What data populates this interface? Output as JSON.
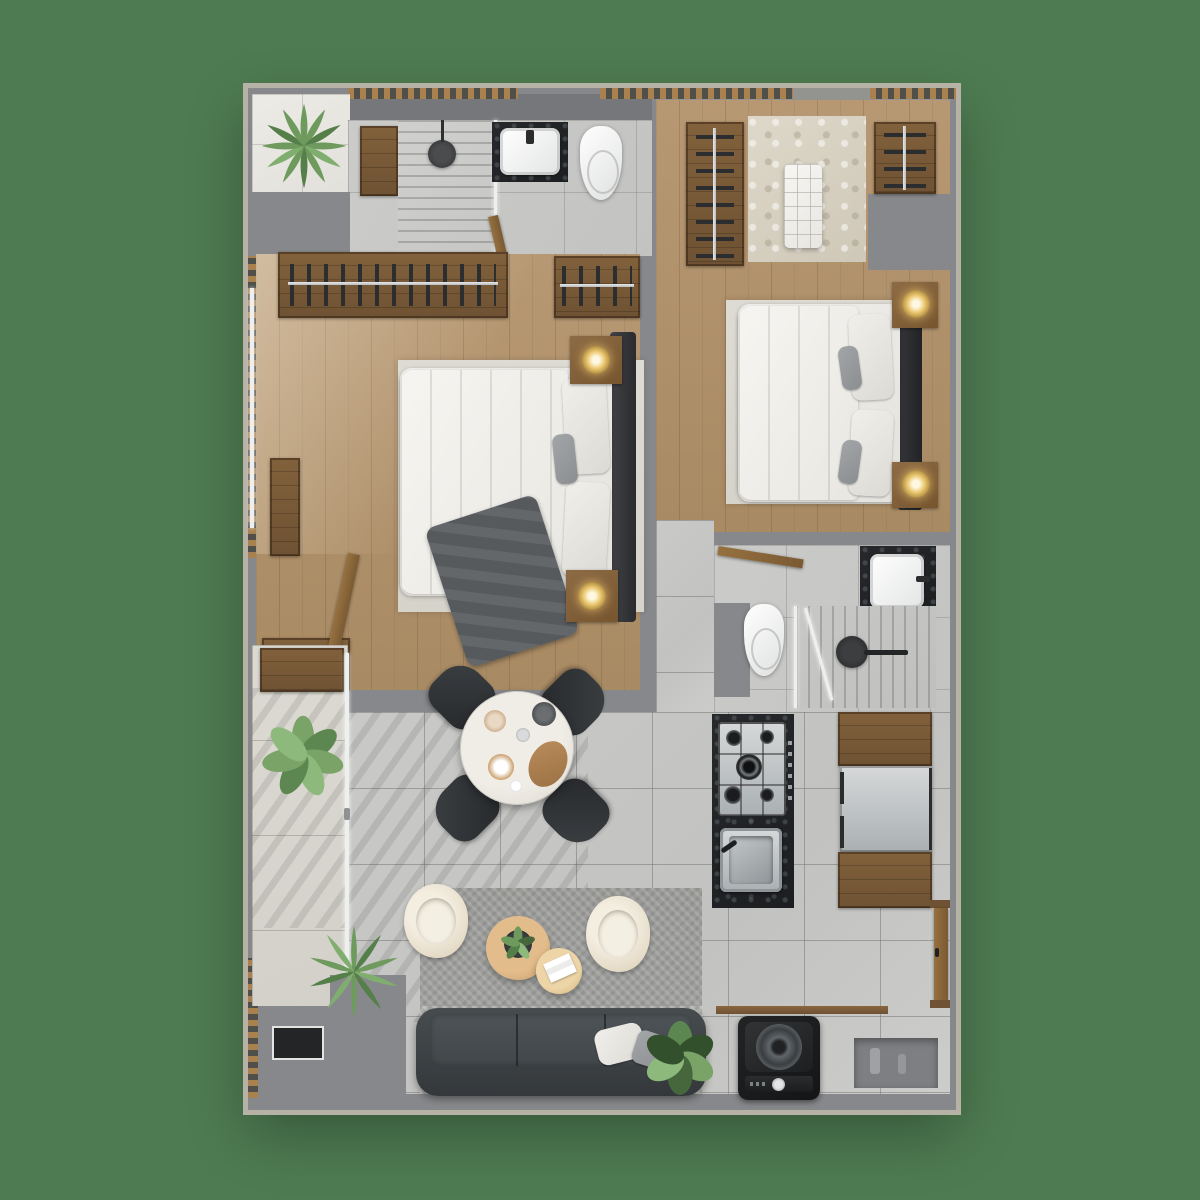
{
  "image": {
    "kind": "apartment floor plan, top-down 3D render",
    "background_color": "#4e7b51",
    "visible_text": "none"
  },
  "palette": {
    "background_green": "#4e7b51",
    "outer_wall": "#b6b2a6",
    "wall_gray": "#87888b",
    "wood_floor": "#b0916c",
    "wood_cabinet": "#7b5d3c",
    "tile_gray": "#c7c7c5",
    "terrace_tile": "#edebe5",
    "dark_counter": "#222427",
    "sofa_gray": "#42474a",
    "armchair_cream": "#e9dfcd",
    "lamp_glow": "#e9c66d",
    "plant_green": "#6f9a5e"
  },
  "rooms": {
    "terrace": {
      "name": "Terrace corner with fern plant",
      "items": [
        "fern-plant",
        "white-tile-floor"
      ]
    },
    "bathroom_1": {
      "name": "Main bathroom",
      "items": [
        "walk-in-shower",
        "black-rain-shower-head",
        "wood-bath-mat",
        "dark-marble-vanity",
        "white-basin",
        "toilet",
        "swing-door"
      ]
    },
    "closet": {
      "name": "Walk-in closet",
      "items": [
        "hanging-rail-left",
        "hanging-rail-right",
        "shag-rug",
        "white-tufted-bench"
      ]
    },
    "bedroom_1": {
      "name": "Master bedroom",
      "items": [
        "double-wardrobe-rail",
        "second-wardrobe-rail",
        "double-bed",
        "white-duvet",
        "gray-throw-blanket",
        "two-pillows",
        "dark-headboard-bench",
        "nightstand-with-lamp-top",
        "nightstand-with-lamp-bottom",
        "wall-console",
        "low-cabinet",
        "area-rug",
        "swing-door"
      ]
    },
    "bedroom_2": {
      "name": "Second bedroom",
      "items": [
        "double-bed",
        "white-duvet",
        "pillows",
        "dark-headboard",
        "nightstand-with-lamp-top",
        "nightstand-with-lamp-bottom",
        "area-rug"
      ]
    },
    "bathroom_2": {
      "name": "Second bathroom",
      "items": [
        "toilet",
        "dark-marble-vanity",
        "white-basin",
        "shower-with-linear-drain",
        "black-rain-shower-head",
        "glass-partition",
        "swing-door"
      ]
    },
    "kitchen": {
      "name": "Kitchen",
      "items": [
        "black-island-counter",
        "gas-cooktop-5-burners",
        "stainless-sink",
        "refrigerator",
        "upper-wood-cabinet",
        "lower-wood-cabinet"
      ],
      "burner_count": 5
    },
    "dining": {
      "name": "Dining area",
      "items": [
        "round-marble-table",
        "four-black-chairs",
        "tableware"
      ],
      "chair_count": 4
    },
    "living": {
      "name": "Living room",
      "items": [
        "three-seat-dark-sofa",
        "two-cream-armchairs",
        "round-wood-coffee-table-with-plant",
        "round-side-table-with-magazine",
        "textured-rug",
        "two-sofa-pillows",
        "palm-plant",
        "monstera-plant"
      ],
      "seat_count": 3
    },
    "balcony": {
      "name": "Balcony",
      "items": [
        "sliding-glass-door",
        "wood-deck-section",
        "alocasia-plant",
        "louver-screen",
        "equipment-panel"
      ]
    },
    "laundry": {
      "name": "Laundry nook",
      "items": [
        "top-load-washing-machine",
        "storage-niche",
        "monstera-plant",
        "wood-threshold"
      ]
    },
    "entry": {
      "name": "Entry",
      "items": [
        "wood-entry-door"
      ]
    }
  }
}
